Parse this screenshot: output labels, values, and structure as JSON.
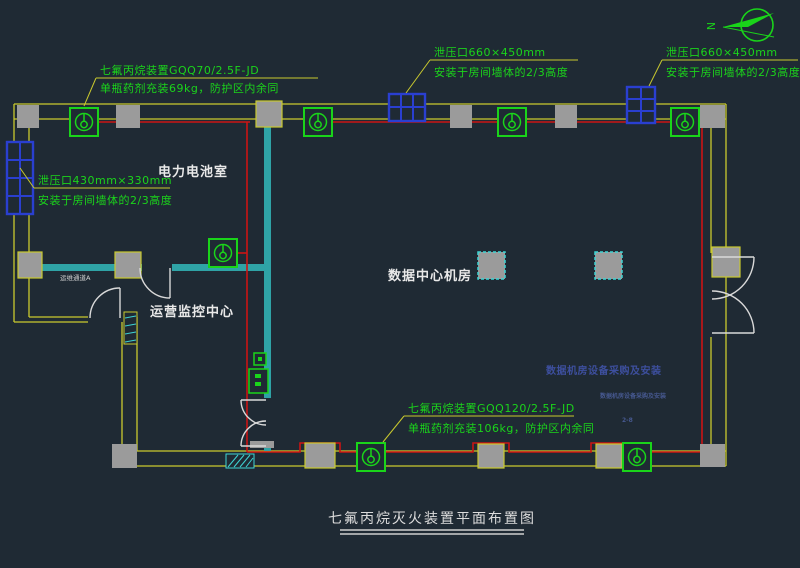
{
  "drawing": {
    "title": "七氟丙烷灭火装置平面布置图",
    "type": "fire-suppression-plan"
  },
  "rooms": {
    "battery": {
      "label": "电力电池室"
    },
    "datacenter": {
      "label": "数据中心机房"
    },
    "monitor": {
      "label": "运营监控中心"
    },
    "corridor": {
      "label": "运维通道A"
    }
  },
  "annotations": {
    "top_left": {
      "line1": "七氟丙烷装置GQQ70/2.5F-JD",
      "line2": "单瓶药剂充装69kg，防护区内余同"
    },
    "top_mid": {
      "line1": "泄压口660×450mm",
      "line2": "安装于房间墙体的2/3高度"
    },
    "top_right": {
      "line1": "泄压口660×450mm",
      "line2": "安装于房间墙体的2/3高度"
    },
    "left": {
      "line1": "泄压口430mm×330mm",
      "line2": "安装于房间墙体的2/3高度"
    },
    "bottom_mid": {
      "line1": "七氟丙烷装置GQQ120/2.5F-JD",
      "line2": "单瓶药剂充装106kg，防护区内余同"
    },
    "blue_note": "数据机房设备采购及安装",
    "xref_tag": "数据机房设备采购及安装",
    "xref_tag2": "2-8",
    "north_letter": "N"
  },
  "colors": {
    "background": "#1f2a34",
    "wall_yellow": "#c9c92e",
    "device_green": "#1ad41a",
    "pipe_red": "#cc1414",
    "vent_blue": "#2a3fd0",
    "partition_teal": "#2fa3a6",
    "column_gray": "#9b9b9b",
    "label_white": "#e9e9e9",
    "note_blue": "#3d4f9e"
  }
}
